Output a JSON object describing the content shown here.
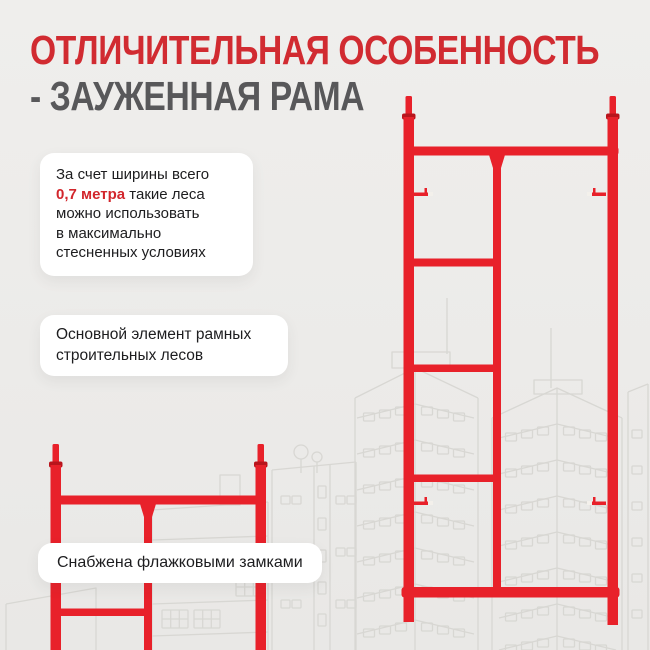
{
  "title": {
    "line1": "ОТЛИЧИТЕЛЬНАЯ ОСОБЕННОСТЬ",
    "line2": "- ЗАУЖЕННАЯ РАМА"
  },
  "cards": [
    {
      "id": "width-feature",
      "lines": [
        {
          "segments": [
            {
              "text": "За счет ширины всего"
            }
          ]
        },
        {
          "segments": [
            {
              "text": "0,7 метра",
              "style": "highlight"
            },
            {
              "text": " такие леса"
            }
          ]
        },
        {
          "segments": [
            {
              "text": "можно использовать"
            }
          ]
        },
        {
          "segments": [
            {
              "text": "в максимально"
            }
          ]
        },
        {
          "segments": [
            {
              "text": "стесненных условиях"
            }
          ]
        }
      ]
    },
    {
      "id": "main-element",
      "lines": [
        {
          "segments": [
            {
              "text": "Основной элемент рамных"
            }
          ]
        },
        {
          "segments": [
            {
              "text": "строительных лесов"
            }
          ]
        }
      ]
    },
    {
      "id": "flag-locks",
      "lines": [
        {
          "segments": [
            {
              "text": "Снабжена флажковыми замками"
            }
          ]
        }
      ]
    }
  ],
  "colors": {
    "background": "#ECEBE9",
    "title_red": "#D12B31",
    "subtitle_gray": "#58585A",
    "highlight_red": "#D2262C",
    "scaffold_red": "#E8212A",
    "scaffold_dark_red": "#B8151C",
    "lock_tip": "#F3F0EB",
    "sketch_line": "#D8D7D3",
    "card_background": "#FFFFFF",
    "card_text": "#1D1D1F"
  }
}
